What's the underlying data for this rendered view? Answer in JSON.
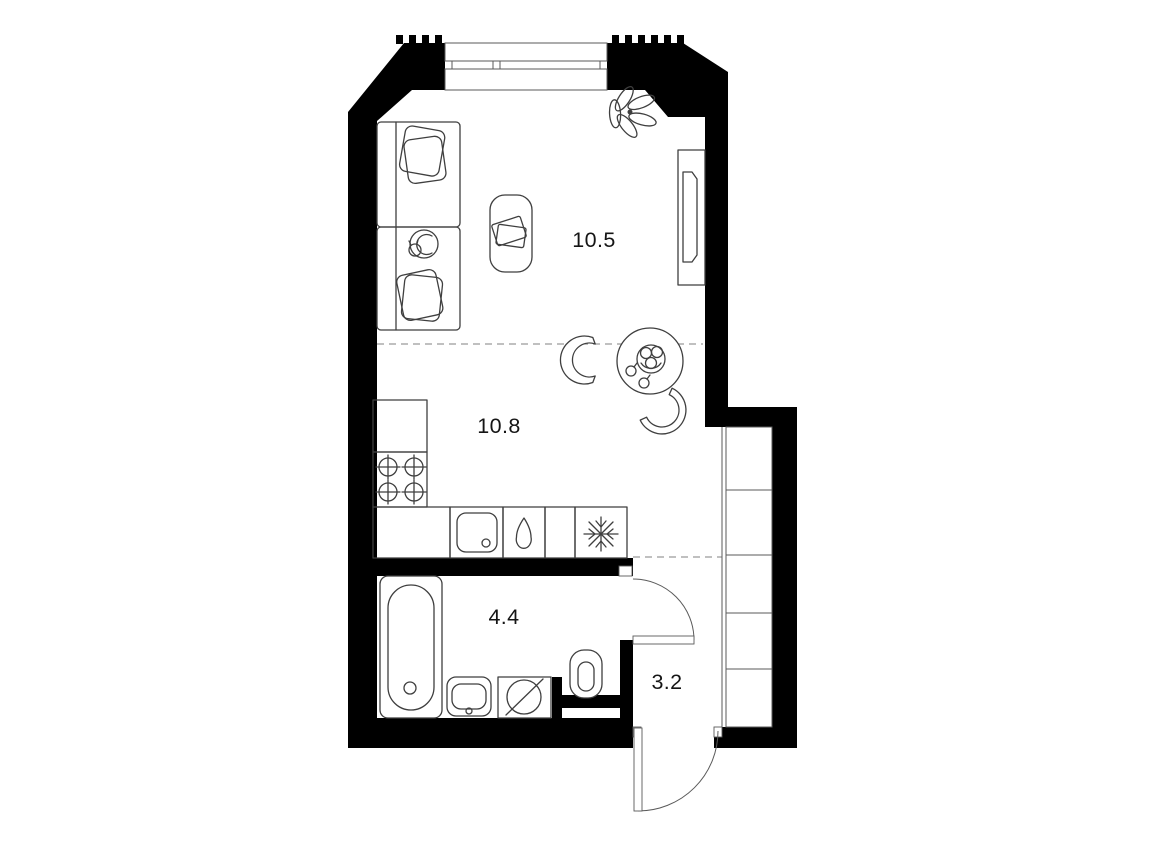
{
  "rooms": {
    "living": {
      "name": "living-room",
      "label": "10.5"
    },
    "kitchen": {
      "name": "kitchen",
      "label": "10.8"
    },
    "bathroom": {
      "name": "bathroom",
      "label": "4.4"
    },
    "hallway": {
      "name": "hallway",
      "label": "3.2"
    }
  },
  "colors": {
    "wall": "#000000",
    "furniture_line": "#3f3f3f",
    "background": "#ffffff",
    "label_text": "#151515",
    "dashed_zone_line": "#9a9a9a"
  },
  "furniture_icons": [
    "bed-icon",
    "pillow-icon",
    "cat-icon",
    "pouf-with-books-icon",
    "plant-icon",
    "tv-console-icon",
    "dining-table-icon",
    "fruit-bowl-icon",
    "chair-icon",
    "counter-icon",
    "stove-burners-icon",
    "kitchen-sink-icon",
    "water-drop-icon",
    "fridge-snowflake-icon",
    "bathtub-icon",
    "washbasin-icon",
    "washing-machine-icon",
    "toilet-icon",
    "wardrobe-shelves-icon",
    "door-swing-icon",
    "window-icon"
  ]
}
